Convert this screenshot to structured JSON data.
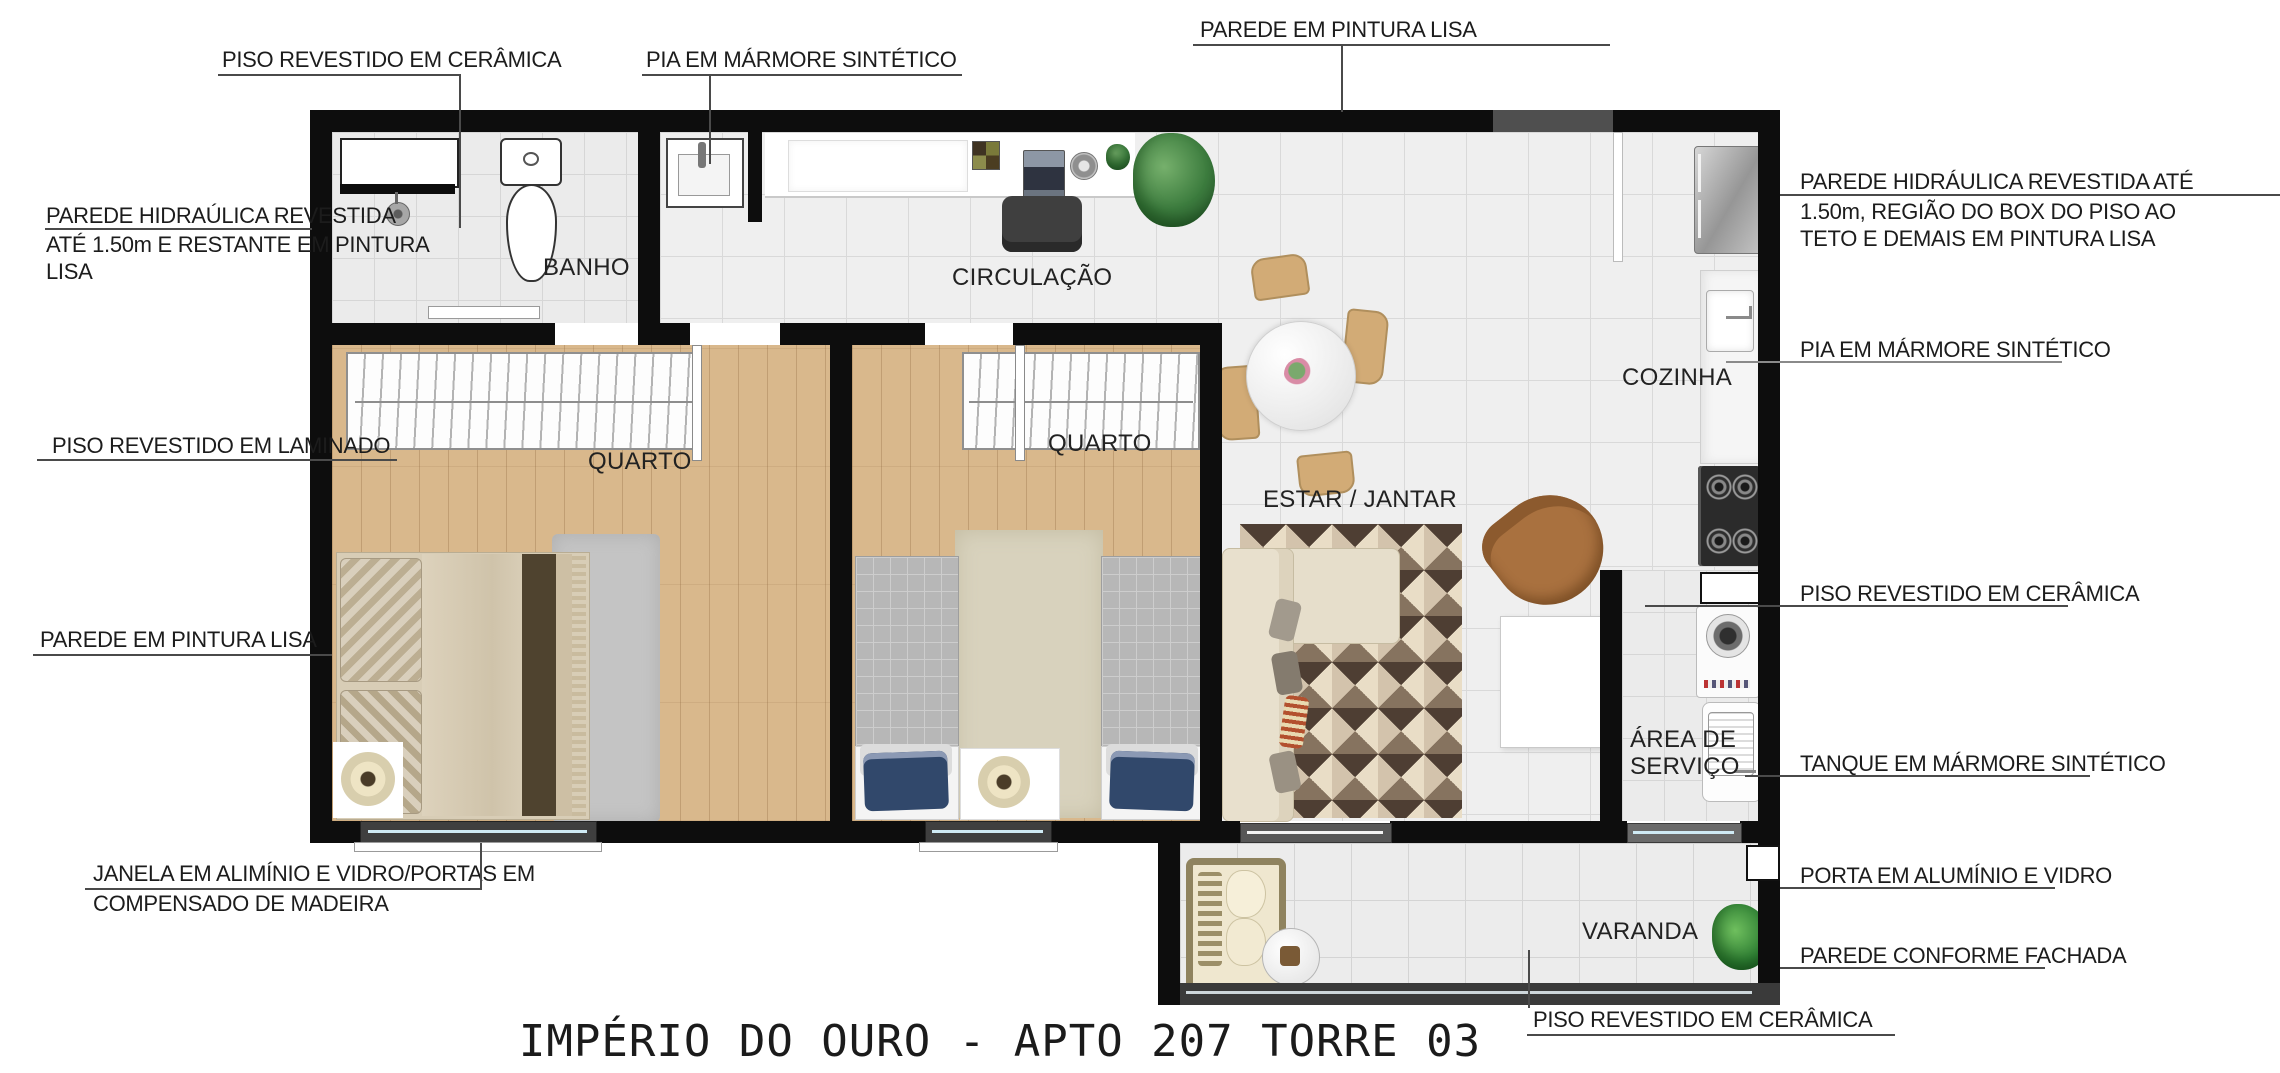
{
  "title": "IMPÉRIO DO OURO - APTO 207 TORRE 03",
  "rooms": {
    "banho": "BANHO",
    "circulacao": "CIRCULAÇÃO",
    "quarto1": "QUARTO",
    "quarto2": "QUARTO",
    "estar_jantar": "ESTAR / JANTAR",
    "cozinha": "COZINHA",
    "area_servico_l1": "ÁREA DE",
    "area_servico_l2": "SERVIÇO",
    "varanda": "VARANDA"
  },
  "callouts": {
    "piso_ceramica_top": "PISO REVESTIDO EM CERÂMICA",
    "pia_top": "PIA EM MÁRMORE SINTÉTICO",
    "parede_pintura_top": "PAREDE EM PINTURA LISA",
    "parede_hidraulica_left_l1": "PAREDE HIDRAÚLICA REVESTIDA",
    "parede_hidraulica_left_l2": "ATÉ 1.50m E RESTANTE EM PINTURA",
    "parede_hidraulica_left_l3": "LISA",
    "piso_laminado_left": "PISO REVESTIDO EM LAMINADO",
    "parede_pintura_left": "PAREDE EM PINTURA LISA",
    "janela_left_l1": "JANELA EM ALIMÍNIO E VIDRO/PORTAS EM",
    "janela_left_l2": "COMPENSADO DE MADEIRA",
    "parede_hidraulica_right_l1": "PAREDE HIDRÁULICA REVESTIDA ATÉ",
    "parede_hidraulica_right_l2": "1.50m, REGIÃO DO BOX DO PISO AO",
    "parede_hidraulica_right_l3": "TETO E DEMAIS EM PINTURA LISA",
    "pia_right": "PIA EM MÁRMORE SINTÉTICO",
    "piso_ceramica_right": "PISO REVESTIDO EM CERÂMICA",
    "tanque_right": "TANQUE EM MÁRMORE SINTÉTICO",
    "porta_right": "PORTA EM ALUMÍNIO E VIDRO",
    "parede_fachada_right": "PAREDE CONFORME FACHADA",
    "piso_ceramica_bottom": "PISO REVESTIDO EM CERÂMICA"
  },
  "colors": {
    "wall": "#0d0d0d",
    "wall_facade": "#4f4f4f",
    "wood_floor": "#d9b88c",
    "tile_floor": "#efefef",
    "window_glass": "#cfeaf4",
    "rug_dark": "#4e3e33",
    "rug_light": "#e9ddc6",
    "sofa": "#e6decb",
    "armchair": "#a9713f",
    "dining_chair": "#d2ab76",
    "plant": "#3c7c3e",
    "bed_blue_pillow": "#31486b",
    "text": "#1c1c1c"
  }
}
